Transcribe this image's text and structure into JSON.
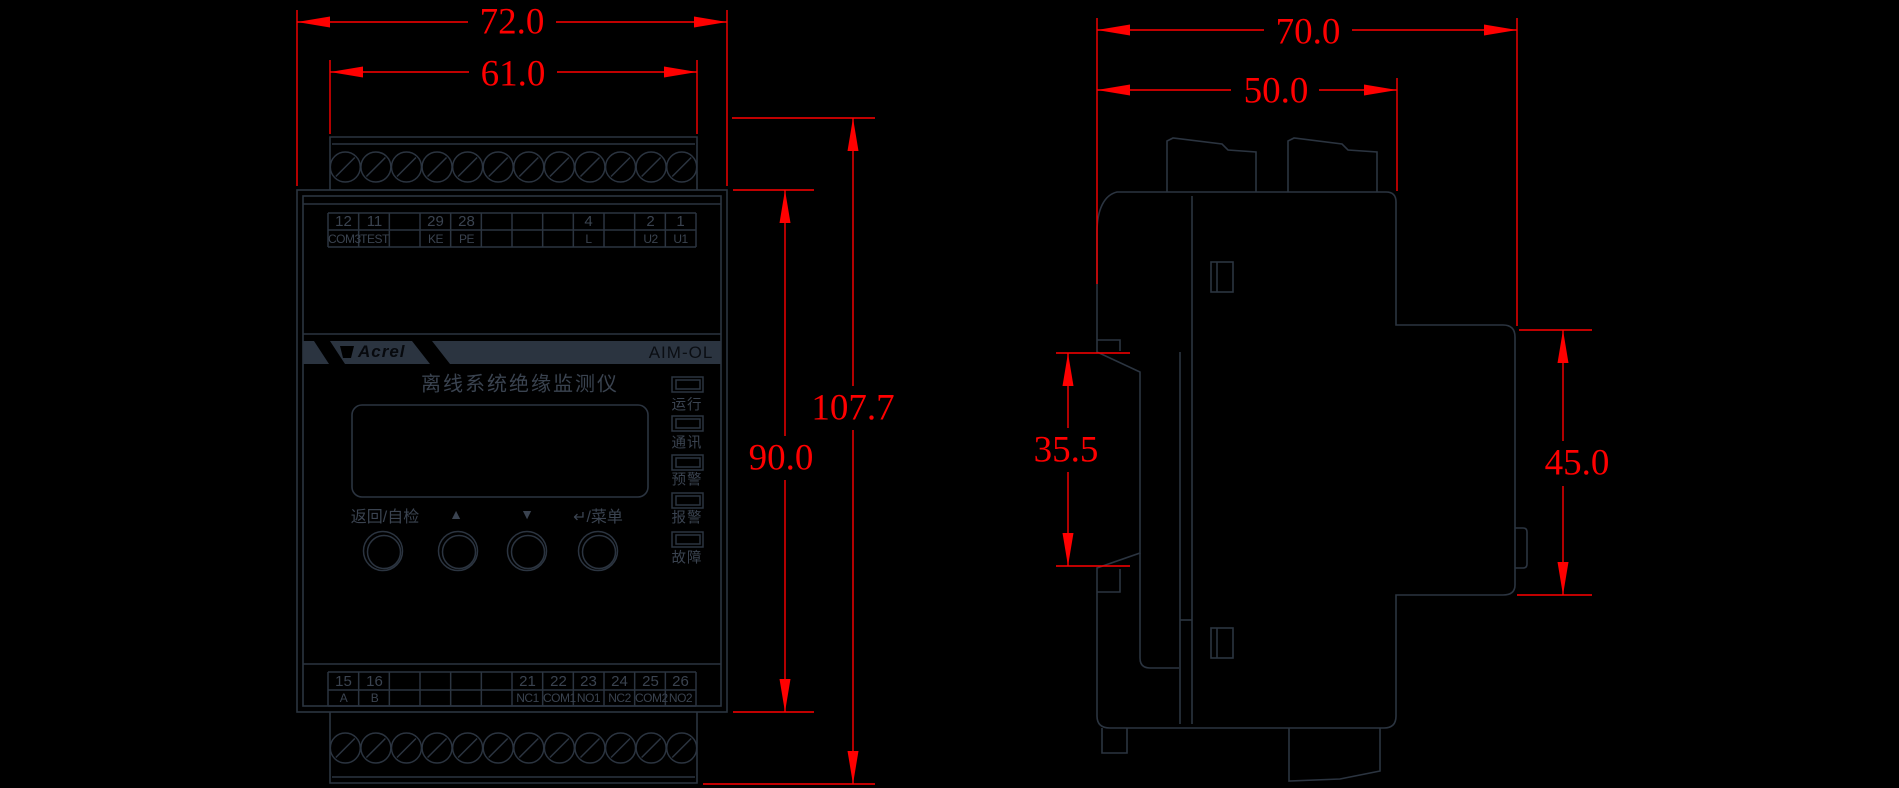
{
  "colors": {
    "background": "#000000",
    "line": "#2b3440",
    "device_text": "#3a4350",
    "dimension_red": "#ff0000"
  },
  "front_view": {
    "dimensions": {
      "width_outer": "72.0",
      "width_inner": "61.0",
      "height_outer": "107.7",
      "height_inner": "90.0"
    },
    "brand": "Acrel",
    "model": "AIM-OL",
    "product_title": "离线系统绝缘监测仪",
    "top_terminals": [
      {
        "num": "12",
        "label": "COM3"
      },
      {
        "num": "11",
        "label": "TEST"
      },
      {
        "num": "",
        "label": ""
      },
      {
        "num": "29",
        "label": "KE"
      },
      {
        "num": "28",
        "label": "PE"
      },
      {
        "num": "",
        "label": ""
      },
      {
        "num": "",
        "label": ""
      },
      {
        "num": "",
        "label": ""
      },
      {
        "num": "4",
        "label": "L"
      },
      {
        "num": "",
        "label": ""
      },
      {
        "num": "2",
        "label": "U2"
      },
      {
        "num": "1",
        "label": "U1"
      }
    ],
    "bottom_terminals": [
      {
        "num": "15",
        "label": "A"
      },
      {
        "num": "16",
        "label": "B"
      },
      {
        "num": "",
        "label": ""
      },
      {
        "num": "",
        "label": ""
      },
      {
        "num": "",
        "label": ""
      },
      {
        "num": "",
        "label": ""
      },
      {
        "num": "21",
        "label": "NC1"
      },
      {
        "num": "22",
        "label": "COM1"
      },
      {
        "num": "23",
        "label": "NO1"
      },
      {
        "num": "24",
        "label": "NC2"
      },
      {
        "num": "25",
        "label": "COM2"
      },
      {
        "num": "26",
        "label": "NO2"
      }
    ],
    "leds": [
      "运行",
      "通讯",
      "预警",
      "报警",
      "故障"
    ],
    "buttons": [
      "返回/自检",
      "▲",
      "▼",
      "↵/菜单"
    ]
  },
  "side_view": {
    "dimensions": {
      "width_outer": "70.0",
      "width_inner": "50.0",
      "rail_section_height": "35.5",
      "front_face_height": "45.0"
    }
  }
}
